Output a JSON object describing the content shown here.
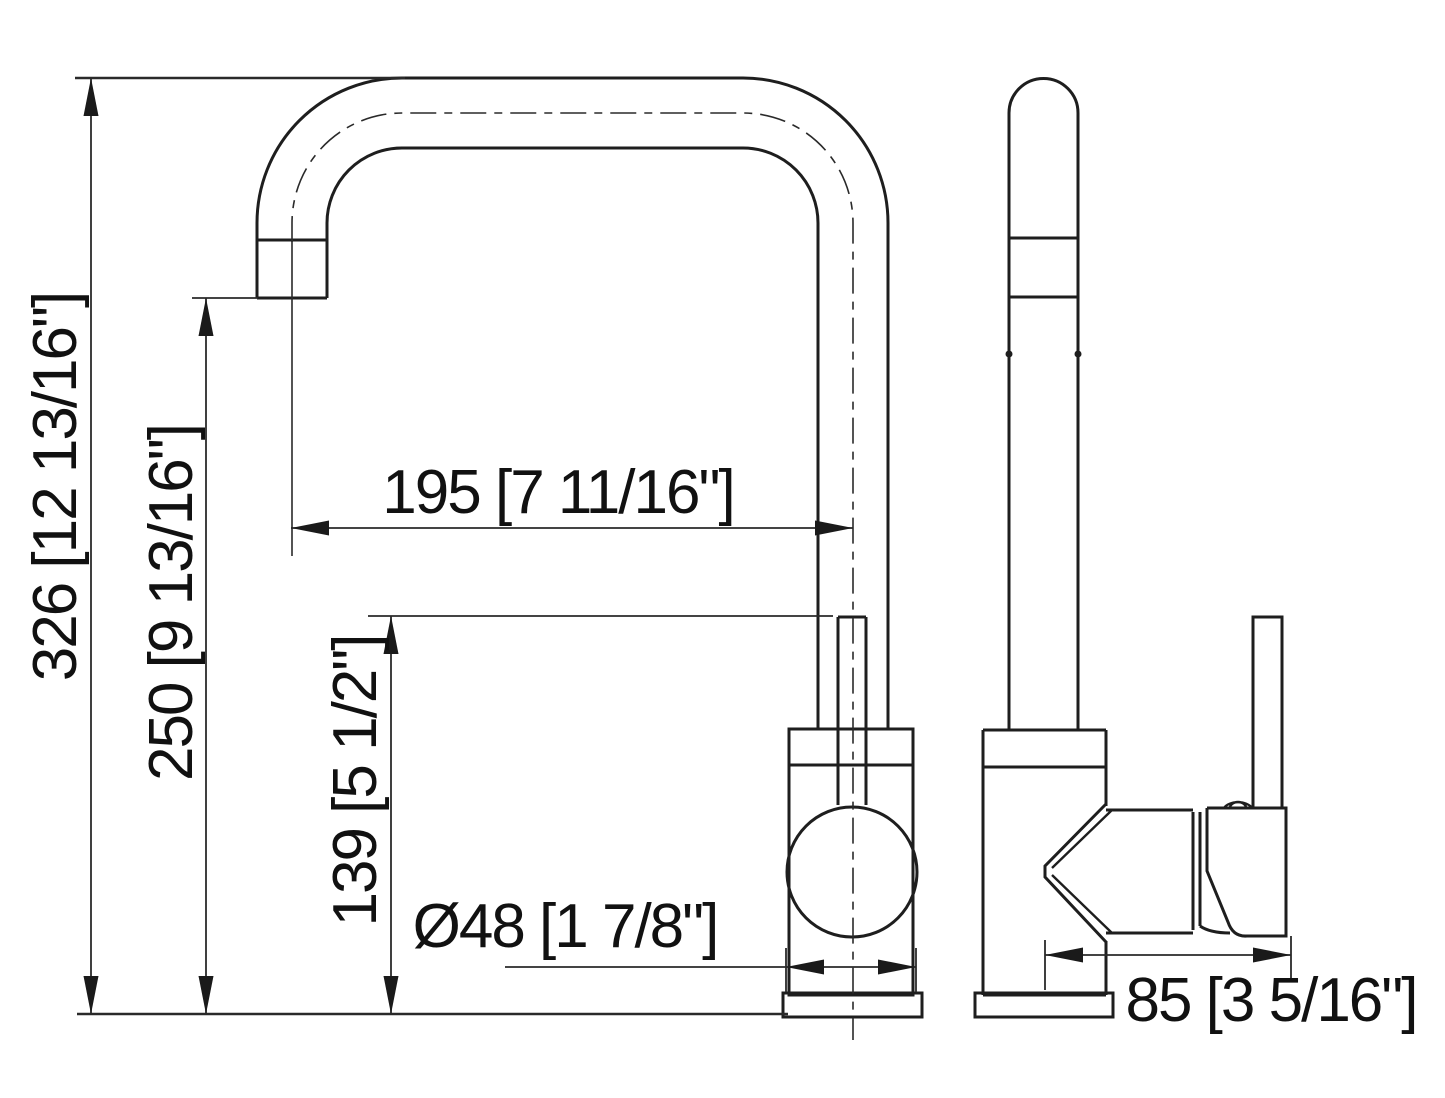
{
  "canvas": {
    "background": "#ffffff",
    "object_line_color": "#1e1e1e",
    "dimension_line_color": "#2a2a2a",
    "text_color": "#111111"
  },
  "drawing": {
    "type": "faucet-technical-dimension-drawing",
    "dimensions": {
      "overall_height": {
        "label": "326 [12 13/16\"]",
        "mm": 326,
        "inches": "12 13/16"
      },
      "spout_height": {
        "label": "250 [9 13/16\"]",
        "mm": 250,
        "inches": "9 13/16"
      },
      "handle_height": {
        "label": "139 [5 1/2\"]",
        "mm": 139,
        "inches": "5 1/2"
      },
      "spout_reach": {
        "label": "195 [7 11/16\"]",
        "mm": 195,
        "inches": "7 11/16"
      },
      "body_diameter": {
        "label": "Ø48 [1 7/8\"]",
        "mm": 48,
        "inches": "1 7/8"
      },
      "handle_length": {
        "label": "85 [3 5/16\"]",
        "mm": 85,
        "inches": "3 5/16"
      }
    }
  }
}
